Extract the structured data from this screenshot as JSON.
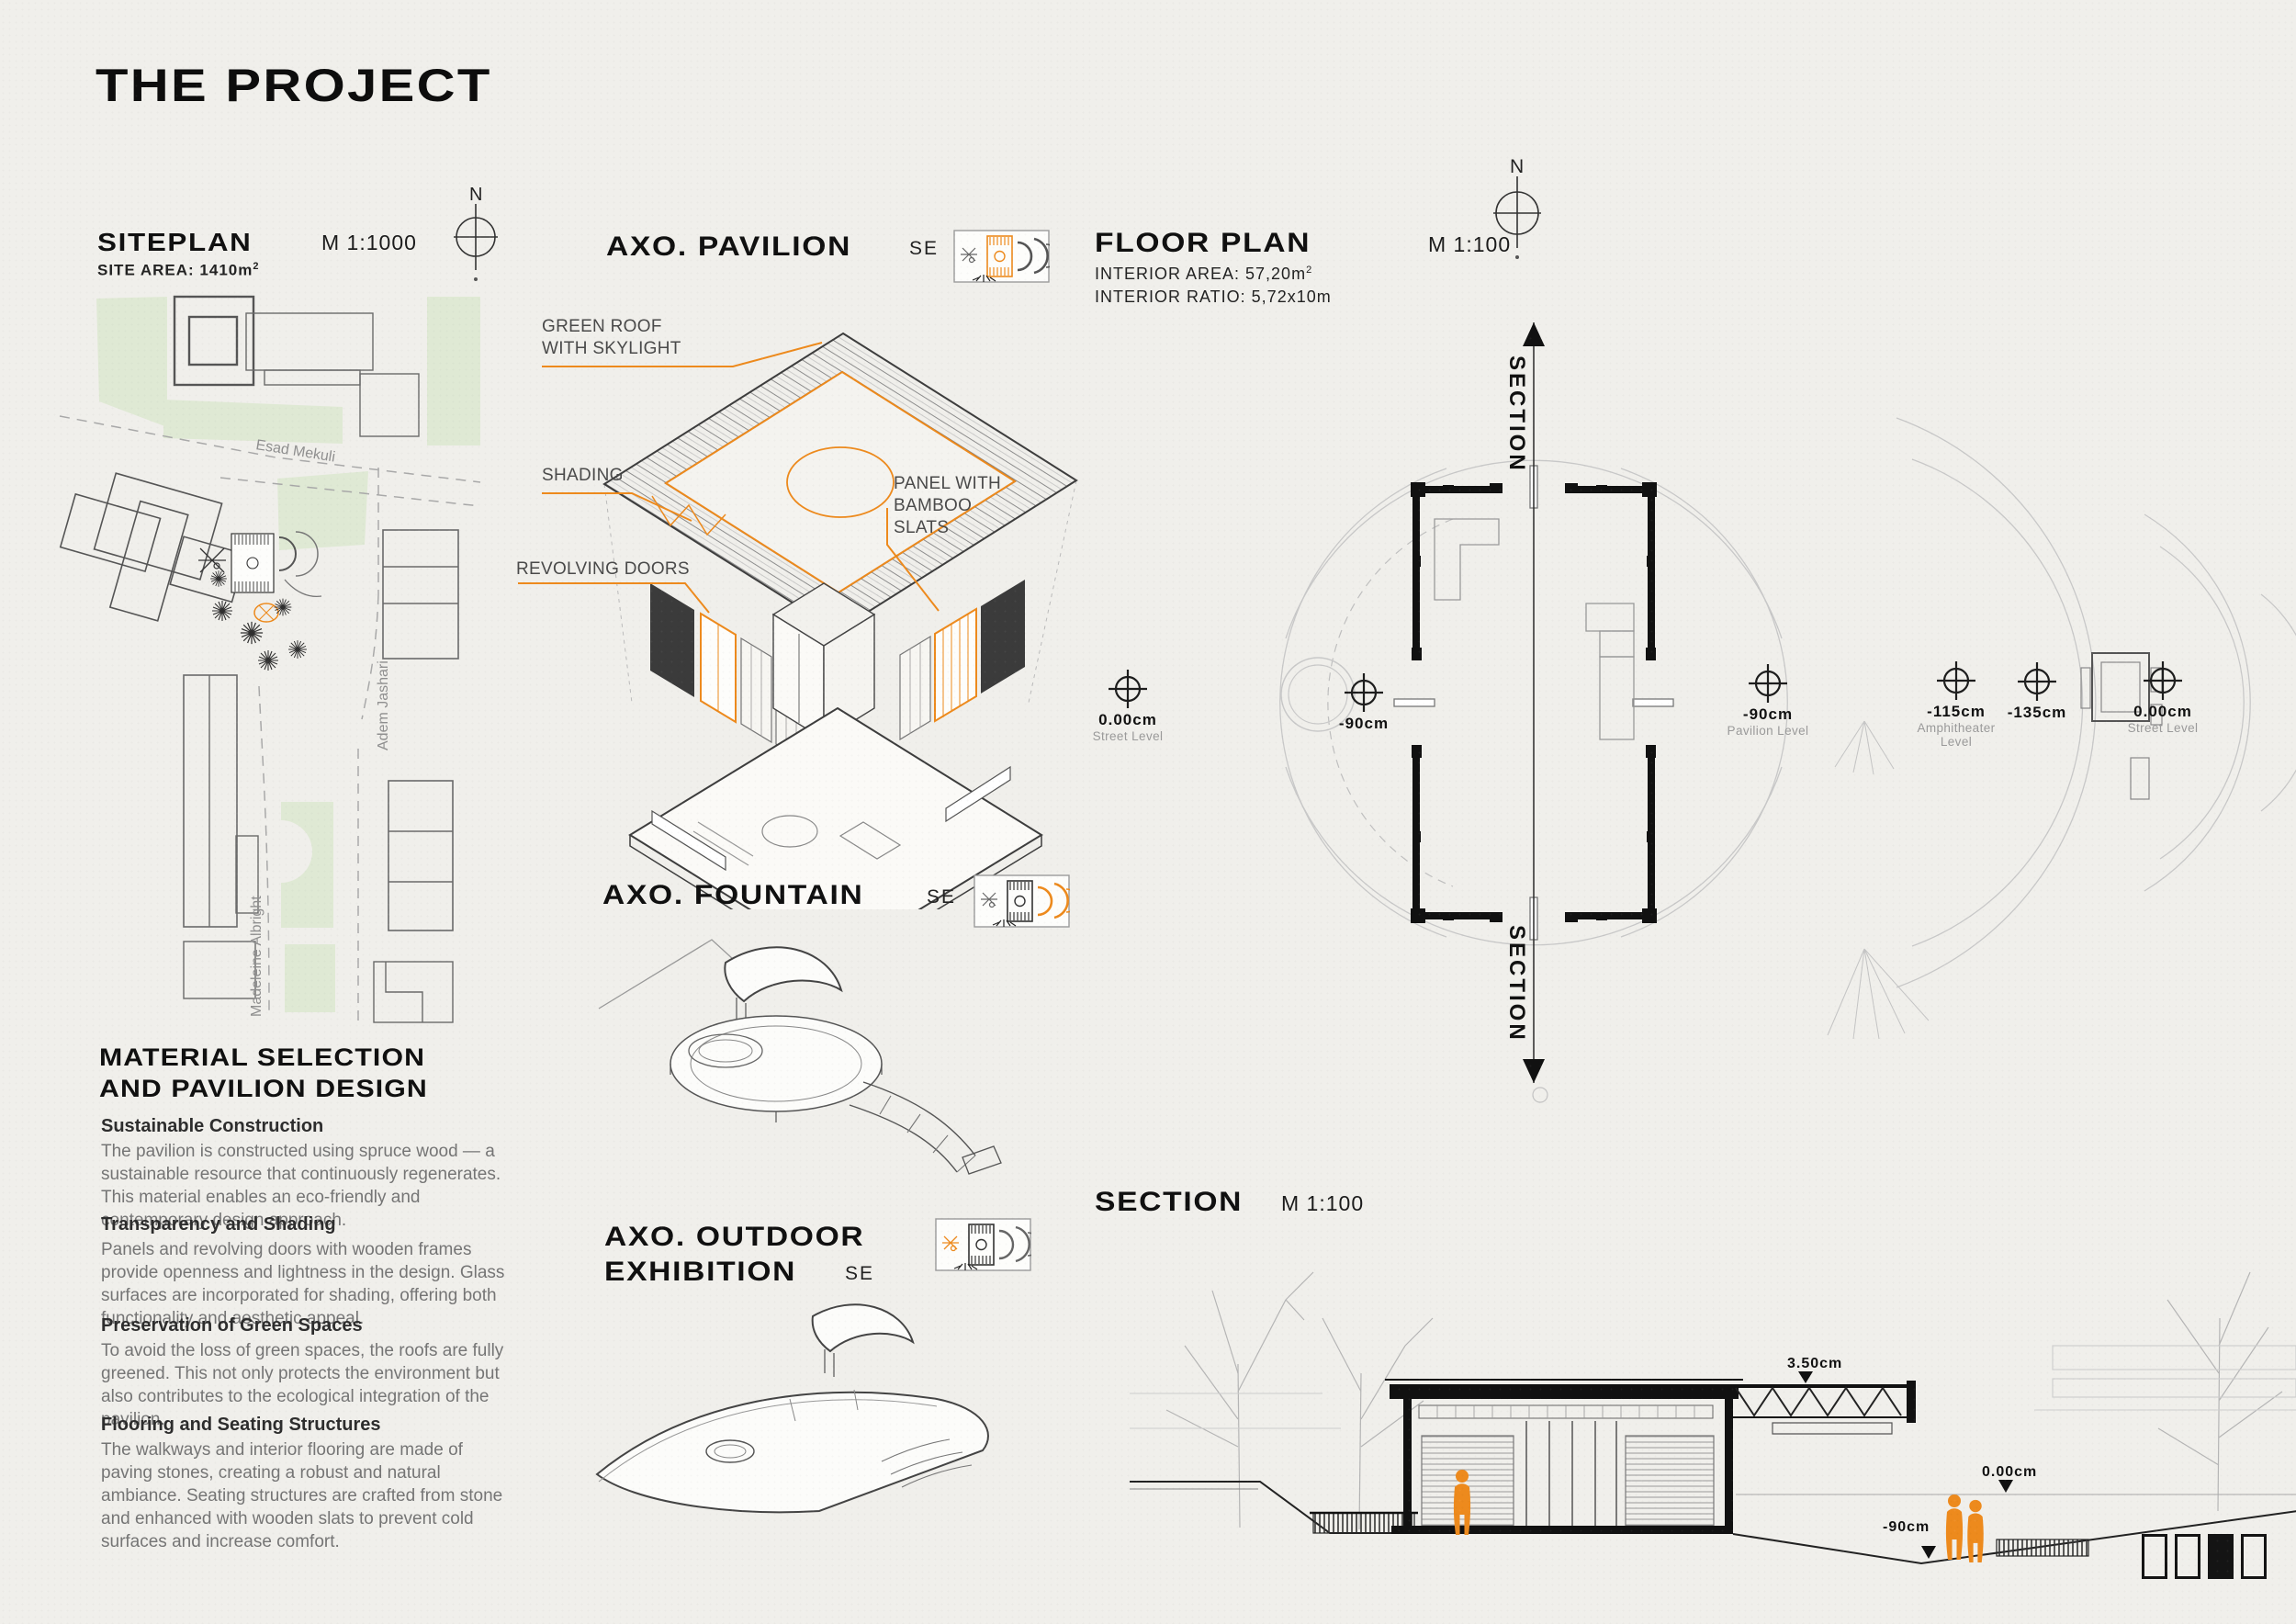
{
  "title": "THE PROJECT",
  "colors": {
    "accent": "#ED8A1D",
    "green": "#DFE9D4",
    "paper": "#F0EFEB",
    "ink": "#151515",
    "body_text": "#757575"
  },
  "siteplan": {
    "title": "SITEPLAN",
    "scale": "M 1:1000",
    "area_label": "SITE AREA: 1410m",
    "area_sup": "2",
    "north": "N",
    "streets": {
      "esad": "Esad Mekuli",
      "adem": "Adem Jashari",
      "madeleine": "Madeleine Albright"
    }
  },
  "axo_pavilion": {
    "title": "AXO. PAVILION",
    "direction": "SE",
    "labels": {
      "roof": "GREEN ROOF WITH SKYLIGHT",
      "shading": "SHADING",
      "doors": "REVOLVING DOORS",
      "panel": "PANEL WITH BAMBOO SLATS"
    }
  },
  "axo_fountain": {
    "title": "AXO. FOUNTAIN",
    "direction": "SE"
  },
  "axo_outdoor": {
    "title_line1": "AXO. OUTDOOR",
    "title_line2": "EXHIBITION",
    "direction": "SE"
  },
  "floor_plan": {
    "title": "FLOOR PLAN",
    "scale": "M 1:100",
    "interior_area": "INTERIOR AREA: 57,20m",
    "interior_area_sup": "2",
    "interior_ratio": "INTERIOR RATIO: 5,72x10m",
    "north": "N",
    "section_label": "SECTION",
    "markers": [
      {
        "value": "0.00cm",
        "label": "Street Level"
      },
      {
        "value": "-90cm",
        "label": ""
      },
      {
        "value": "-90cm",
        "label": "Pavilion Level"
      },
      {
        "value": "-115cm",
        "label": "Amphitheater Level"
      },
      {
        "value": "-135cm",
        "label": ""
      },
      {
        "value": "0.00cm",
        "label": "Street Level"
      }
    ]
  },
  "section": {
    "title": "SECTION",
    "scale": "M 1:100",
    "labels": {
      "roof": "3.50cm",
      "street": "0.00cm",
      "floor": "-90cm"
    }
  },
  "material": {
    "heading_line1": "MATERIAL SELECTION",
    "heading_line2": "AND PAVILION DESIGN",
    "paragraphs": [
      {
        "title": "Sustainable Construction",
        "body": "The pavilion is constructed using spruce wood — a sustainable resource that continuously regenerates. This material enables an eco-friendly and contemporary design approach."
      },
      {
        "title": "Transparency and Shading",
        "body": "Panels and revolving doors with wooden frames provide openness and lightness in the design. Glass surfaces are incorporated for shading, offering both functionality and aesthetic appeal."
      },
      {
        "title": "Preservation of Green Spaces",
        "body": "To avoid the loss of green spaces, the roofs are fully greened. This not only protects the environment but also contributes to the ecological integration of the pavilion."
      },
      {
        "title": "Flooring and Seating Structures",
        "body": "The walkways and interior flooring are made of paving stones, creating a robust and natural ambiance. Seating structures are crafted from stone and enhanced with wooden slats to prevent cold surfaces and increase comfort."
      }
    ]
  },
  "pager": {
    "pages": 4,
    "active": 3
  }
}
